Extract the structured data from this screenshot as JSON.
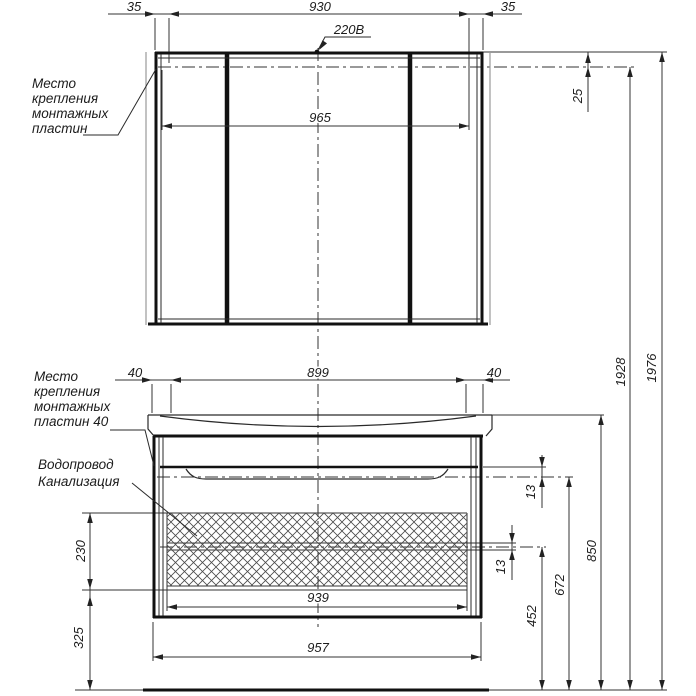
{
  "mirror_cabinet": {
    "mount_note": [
      "Место",
      "крепления",
      "монтажных",
      "пластин"
    ],
    "dim_side_left": "35",
    "dim_center": "930",
    "dim_side_right": "35",
    "dim_mount_length": "965",
    "dim_top_offset": "25",
    "power_label": "220В"
  },
  "vanity_cabinet": {
    "mount_note": [
      "Место",
      "крепления",
      "монтажных",
      "пластин 40"
    ],
    "plumbing_note": [
      "Водопровод",
      "Канализация"
    ],
    "dim_side_left": "40",
    "dim_center": "899",
    "dim_side_right": "40",
    "dim_drawer_gap_top": "13",
    "dim_drawer_gap_mid": "13",
    "dim_hatch_height": "230",
    "dim_below_offset": "325",
    "dim_inner_width": "939",
    "dim_outer_width": "957"
  },
  "height_dims": {
    "sewage_center": "452",
    "water_center": "672",
    "countertop": "850",
    "mount_line": "1928",
    "overall": "1976"
  }
}
